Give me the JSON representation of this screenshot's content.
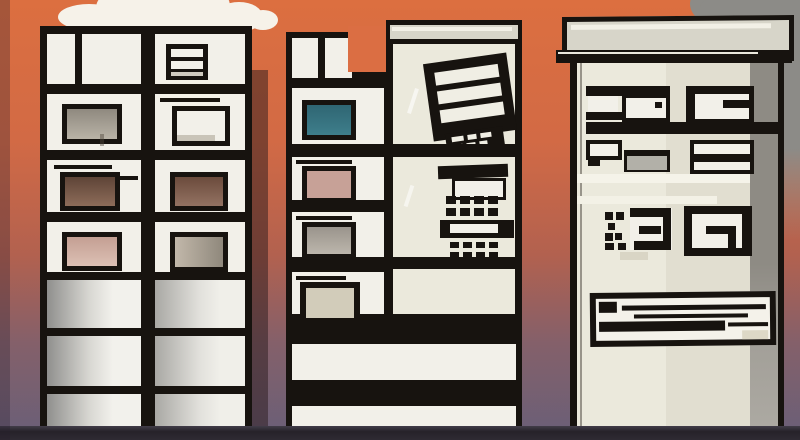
{
  "scene": {
    "description": "Stylized comic illustration of three tall retro buildings with black-outlined windows against an orange-to-purple gradient sky, a white cloud at upper left, gray smoke at upper right and a dark ground strip",
    "objects": [
      "left-tower-1",
      "left-tower-2",
      "middle-tower",
      "right-building",
      "white-cloud",
      "smoke-cloud",
      "ground"
    ]
  },
  "palette": {
    "sky_top": "#DC6F40",
    "sky_mid": "#B2614F",
    "sky_bottom": "#695F78",
    "outline": "#17130F",
    "panel_white": "#F2F0E9",
    "cream": "#EBE9DC",
    "cream_dark": "#E1DED0",
    "roof_cap": "#D7D5C9",
    "gray_column": "#8E8B84",
    "gray_unit": "#B2B0A8",
    "cloud_white": "#F6F2E9",
    "cloud_gray": "#8C8B87",
    "ground_dark": "#28242C",
    "window_teal": "#3E7E8B",
    "window_pink": "#C7A197",
    "window_tan": "#D2CCBA",
    "window_brown": "#6B4B3C",
    "window_gray": "#ABA49C"
  },
  "windows": {
    "left_tower_1": [
      "split-panel",
      "gray-sill",
      "brown",
      "pink"
    ],
    "left_tower_2": [
      "louver",
      "white",
      "brown",
      "taupe"
    ],
    "middle_tower": [
      "teal",
      "pink",
      "gray",
      "tan"
    ],
    "right_building_window_rows": 3,
    "middle_tower_ac_units": 3
  }
}
